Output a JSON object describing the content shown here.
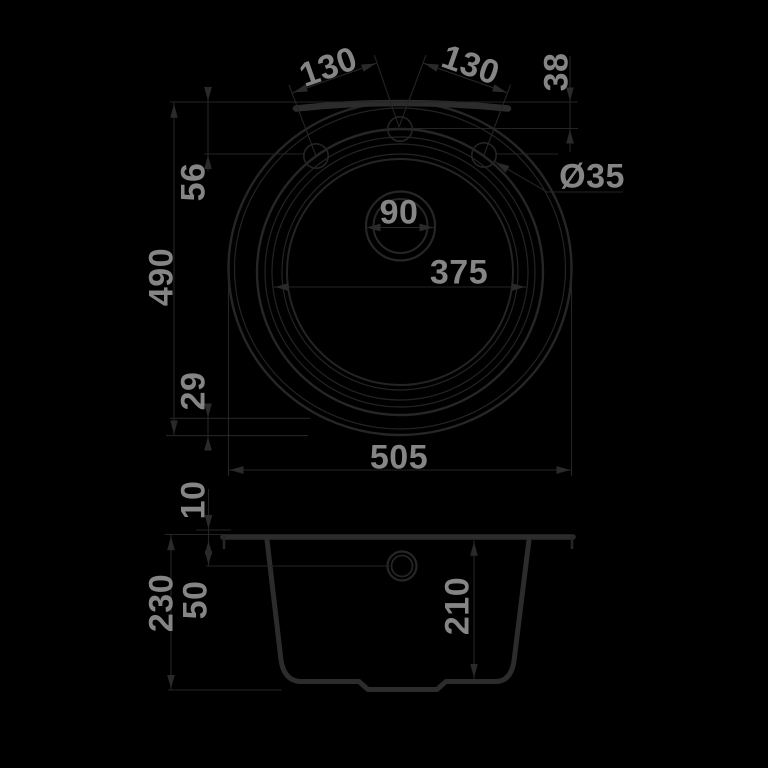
{
  "drawing": {
    "title": "sink-technical-drawing",
    "subject": "round kitchen sink, top view and front section view",
    "units": "mm",
    "colors": {
      "background": "#000000",
      "line": "#262626",
      "text": "#858585"
    },
    "dims": {
      "hole_pitch_left": "130",
      "hole_pitch_right": "130",
      "rim_to_center_hole": "38",
      "rim_to_side_holes": "56",
      "overall_depth": "490",
      "bowl_to_edge": "29",
      "faucet_hole_diameter": "Ø35",
      "drain_diameter": "90",
      "bowl_diameter": "375",
      "overall_width": "505",
      "rim_height": "10",
      "total_height": "230",
      "overflow_depth": "50",
      "bowl_depth": "210"
    }
  }
}
